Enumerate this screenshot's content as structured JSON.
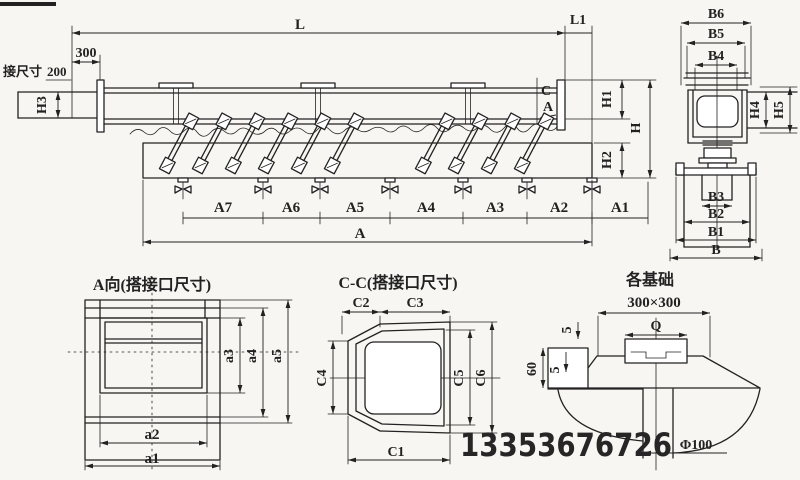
{
  "colors": {
    "ink": "#222222",
    "paper": "#f7f6f2",
    "watermark": "#262626"
  },
  "main_view": {
    "dim_L": "L",
    "dim_L1": "L1",
    "dim_300": "300",
    "conn_label": "接尺寸",
    "conn_value": "200",
    "dim_H3": "H3",
    "dim_H1": "H1",
    "dim_H": "H",
    "dim_H2": "H2",
    "section_C": "C",
    "view_A": "A",
    "dim_A7": "A7",
    "dim_A6": "A6",
    "dim_A5": "A5",
    "dim_A4": "A4",
    "dim_A3": "A3",
    "dim_A2": "A2",
    "dim_A1": "A1",
    "dim_A": "A"
  },
  "side_view": {
    "dim_B6": "B6",
    "dim_B5": "B5",
    "dim_B4": "B4",
    "dim_H4": "H4",
    "dim_H5": "H5",
    "dim_B3": "B3",
    "dim_B2": "B2",
    "dim_B1": "B1",
    "dim_B": "B"
  },
  "a_view": {
    "title": "A向(搭接口尺寸)",
    "dim_a1": "a1",
    "dim_a2": "a2",
    "dim_a3": "a3",
    "dim_a4": "a4",
    "dim_a5": "a5"
  },
  "cc_view": {
    "title": "C-C(搭接口尺寸)",
    "dim_C1": "C1",
    "dim_C2": "C2",
    "dim_C3": "C3",
    "dim_C4": "C4",
    "dim_C5": "C5",
    "dim_C6": "C6"
  },
  "foundation": {
    "title": "各基础",
    "dim_size": "300×300",
    "dim_Q": "Q",
    "dim_5a": "5",
    "dim_5b": "5",
    "dim_60": "60",
    "dim_phi": "Φ100"
  },
  "watermark_phone": "13353676726"
}
